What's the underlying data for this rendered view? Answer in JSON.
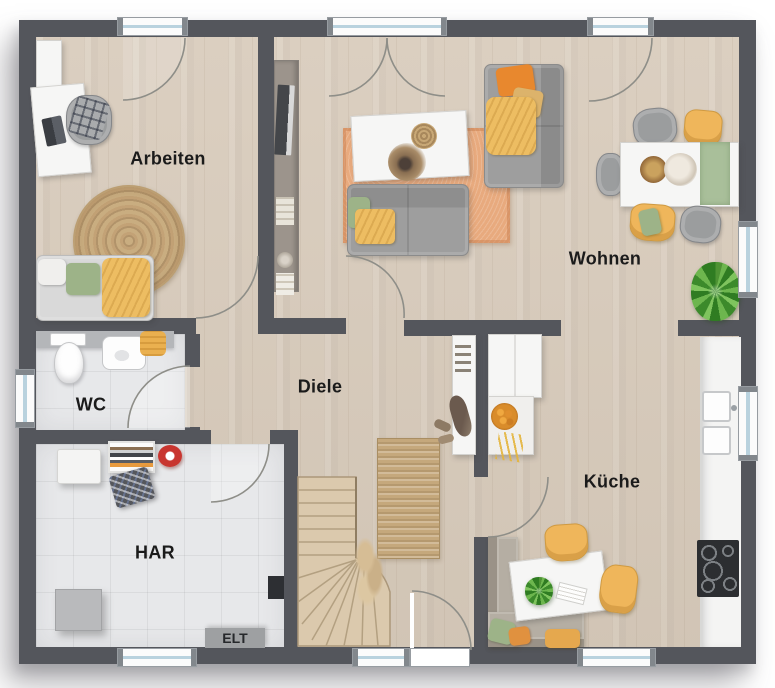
{
  "plan": {
    "rooms": [
      {
        "id": "arbeiten",
        "label": "Arbeiten"
      },
      {
        "id": "wohnen",
        "label": "Wohnen"
      },
      {
        "id": "diele",
        "label": "Diele"
      },
      {
        "id": "wc",
        "label": "WC"
      },
      {
        "id": "har",
        "label": "HAR"
      },
      {
        "id": "kueche",
        "label": "Küche"
      }
    ],
    "elt_label": "ELT"
  },
  "colors": {
    "wall": "#54565c",
    "wood": "#d8cbbb",
    "tile": "#e7e8ea",
    "rug_orange": "#e8aa7e",
    "jute": "#c5a87c",
    "sofa_gray": "#9e9e9e",
    "pillow_yellow": "#edbd62",
    "pillow_green": "#9db388",
    "pillow_orange": "#e8882e",
    "chair_yellow": "#efb65b",
    "stairs_wood": "#dbc9ad",
    "white_furniture": "#f6f6f5",
    "window_glass": "#b9d2de",
    "elt_gray": "#9ea0a2",
    "plant_green": "#4e9334",
    "cooktop_black": "#2c2e31",
    "label_ink": "#1b1b1b"
  }
}
